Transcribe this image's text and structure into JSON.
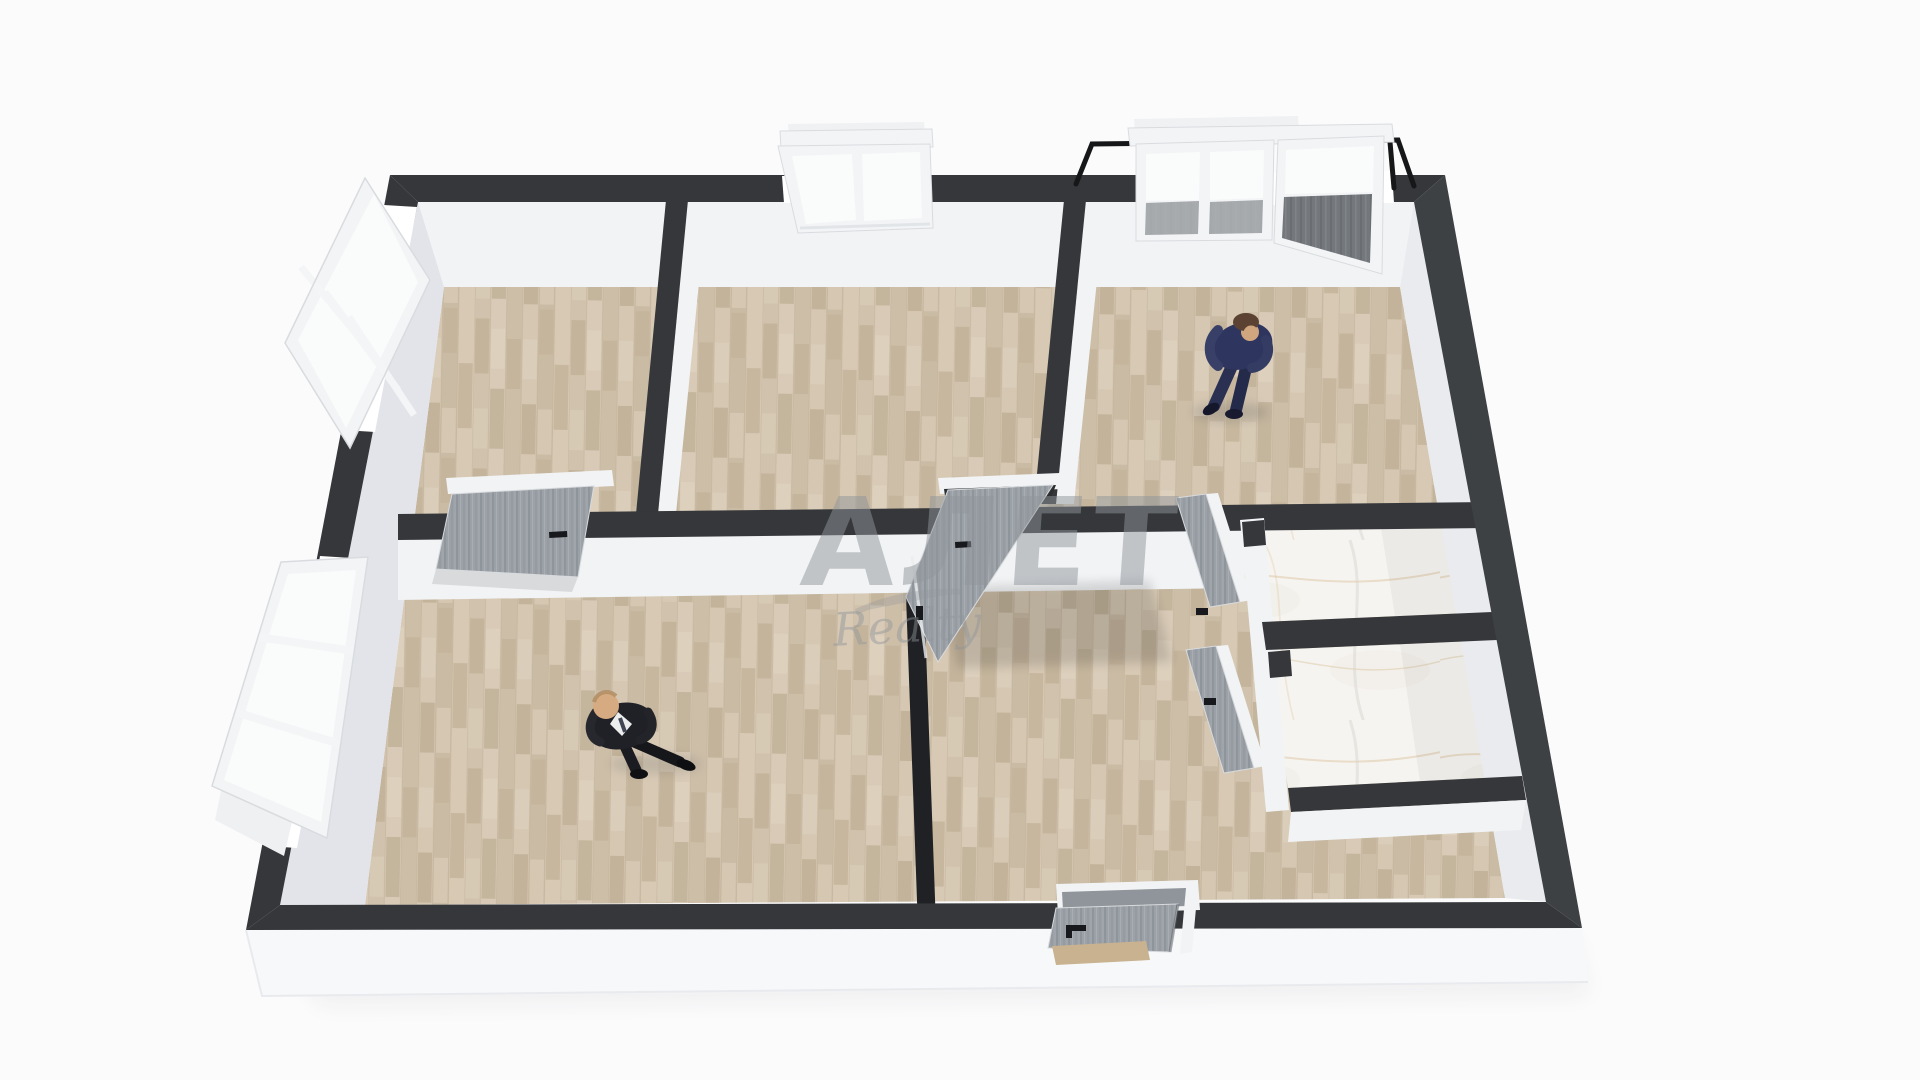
{
  "scene": {
    "kind": "3d-floor-plan-render",
    "description_elements": {
      "rooms_wood_floor": 5,
      "rooms_marble_floor": 2,
      "open_windows": 2,
      "closed_windows": 2,
      "balcony_door": 1,
      "interior_doors": 4,
      "entrance_door": 1,
      "people": 2
    }
  },
  "watermark": {
    "title": "АЛЕТ",
    "subtitle": "Realty"
  },
  "colors": {
    "background": "#fbfbfc",
    "wall_top": "#35373a",
    "wall_top_light": "#3e4144",
    "wall_face": "#f1f3f5",
    "wall_face_west": "#e2e4ea",
    "wall_face_shadow": "#e9ebee",
    "wall_thin_dark": "#1f2124",
    "floor_wood": "#d5c7b2",
    "marble_base": "#f6f4f1",
    "door_gray": "#9ba1a7",
    "door_frame": "#f2f3f4",
    "window_frame": "#f3f4f6",
    "window_glass": "#fafbfb",
    "glass_dark": "#74787c",
    "railing": "#161718",
    "suit_navy": "#2e355e",
    "suit_black": "#202127",
    "skin": "#d0a67e",
    "front_face": "#f7f8fa",
    "watermark_gray": "#90969b"
  }
}
